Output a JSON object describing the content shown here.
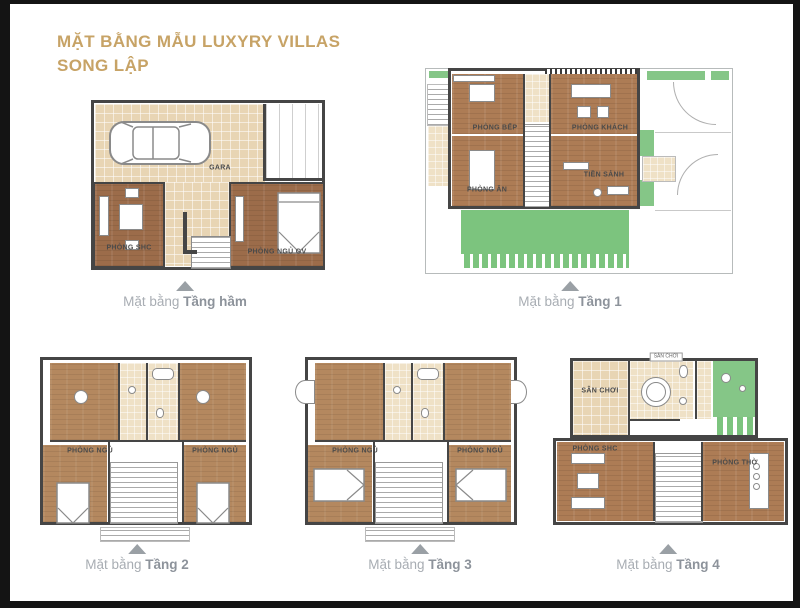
{
  "title": {
    "line1": "MẶT BẰNG MẪU LUXYRY VILLAS",
    "line2": "SONG LẬP"
  },
  "captions": {
    "prefix": "Mặt bằng",
    "basement": "Tầng hầm",
    "f1": "Tầng 1",
    "f2": "Tầng 2",
    "f3": "Tầng 3",
    "f4": "Tầng 4"
  },
  "rooms": {
    "basement": {
      "gara": "GARA",
      "shc": "PHÒNG SHC",
      "ngu_gv": "PHÒNG NGỦ GV"
    },
    "f1": {
      "bep": "PHÒNG BẾP",
      "khach": "PHÒNG KHÁCH",
      "an": "PHÒNG ĂN",
      "tien_sanh": "TIỀN SẢNH"
    },
    "f2": {
      "ngu_left": "PHÒNG NGỦ",
      "ngu_right": "PHÒNG NGỦ"
    },
    "f3": {
      "ngu_left": "PHÒNG NGỦ",
      "ngu_right": "PHÒNG NGỦ"
    },
    "f4": {
      "san_choi": "SÂN CHƠI",
      "san_choi_top": "SÂN CHƠI",
      "shc": "PHÒNG SHC",
      "tho": "PHÒNG THỜ"
    }
  },
  "colors": {
    "title_gold": "#c7a366",
    "wood_floor": "#ad7c55",
    "wood_floor_dark": "#9c6c4a",
    "tile_beige": "#e8d5b4",
    "lawn_green": "#7cc47e",
    "wall_gray": "#454545",
    "caption_gray": "#a8adb3"
  }
}
